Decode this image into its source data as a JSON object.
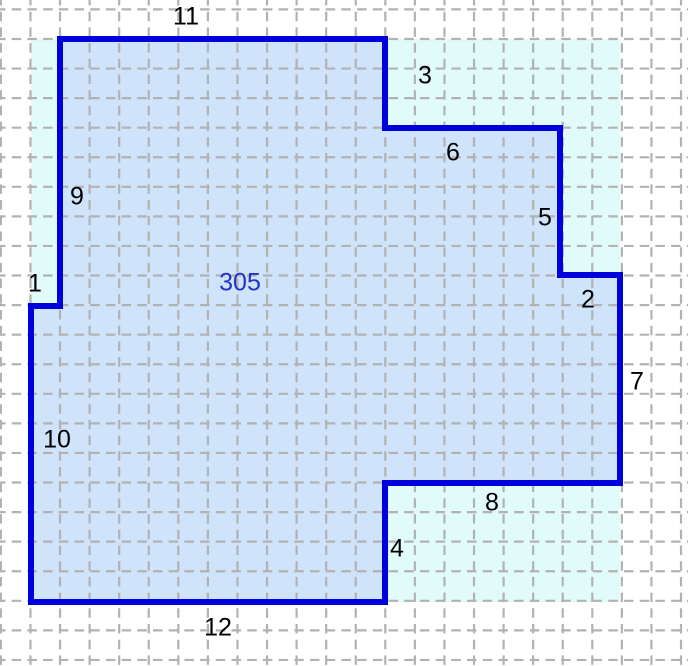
{
  "canvas": {
    "width": 688,
    "height": 666
  },
  "colors": {
    "background": "#ffffff",
    "grid_line": "#b2b2b2",
    "bounding_fill": "#e1fbfb",
    "polygon_fill": "#cfe3fb",
    "polygon_stroke": "#0000dd",
    "side_label_color": "#000000",
    "area_label_color": "#2233cc"
  },
  "figure": {
    "description": "Rectilinear polygon on a dashed grid; each numbered label gives the length of its side in grid units; blue number is the enclosed area",
    "grid": {
      "x0": 0.9,
      "y0": 9.4,
      "step": 29.57,
      "dash": "9.5 6.2",
      "stroke_width": 2.2,
      "color": "#b2b2b2"
    },
    "grid_unit_px": 29.6,
    "bounding_box_px": {
      "x": 31,
      "y": 39,
      "width": 589,
      "height": 563
    },
    "bounding_box_units": {
      "width": 20,
      "height": 19
    },
    "polygon_points_px": "60,39 385,39 385,128 560,128 560,275 620,275 620,483 385,483 385,602 31,602 31,306 60,306",
    "vertices_units": [
      [
        1,
        0
      ],
      [
        12,
        0
      ],
      [
        12,
        3
      ],
      [
        18,
        3
      ],
      [
        18,
        8
      ],
      [
        20,
        8
      ],
      [
        20,
        15
      ],
      [
        12,
        15
      ],
      [
        12,
        19
      ],
      [
        0,
        19
      ],
      [
        0,
        9
      ],
      [
        1,
        9
      ]
    ],
    "stroke_width": 6,
    "area_value": 305,
    "area_label": {
      "text": "305",
      "x": 240,
      "y": 283
    },
    "side_labels": [
      {
        "text": "1",
        "x": 35,
        "y": 284
      },
      {
        "text": "2",
        "x": 588,
        "y": 300
      },
      {
        "text": "3",
        "x": 425,
        "y": 76
      },
      {
        "text": "4",
        "x": 397,
        "y": 549
      },
      {
        "text": "5",
        "x": 545,
        "y": 218
      },
      {
        "text": "6",
        "x": 453,
        "y": 153
      },
      {
        "text": "7",
        "x": 637,
        "y": 382
      },
      {
        "text": "8",
        "x": 492,
        "y": 503
      },
      {
        "text": "9",
        "x": 77,
        "y": 197
      },
      {
        "text": "10",
        "x": 57,
        "y": 440
      },
      {
        "text": "11",
        "x": 186,
        "y": 17
      },
      {
        "text": "12",
        "x": 218,
        "y": 628
      }
    ]
  }
}
